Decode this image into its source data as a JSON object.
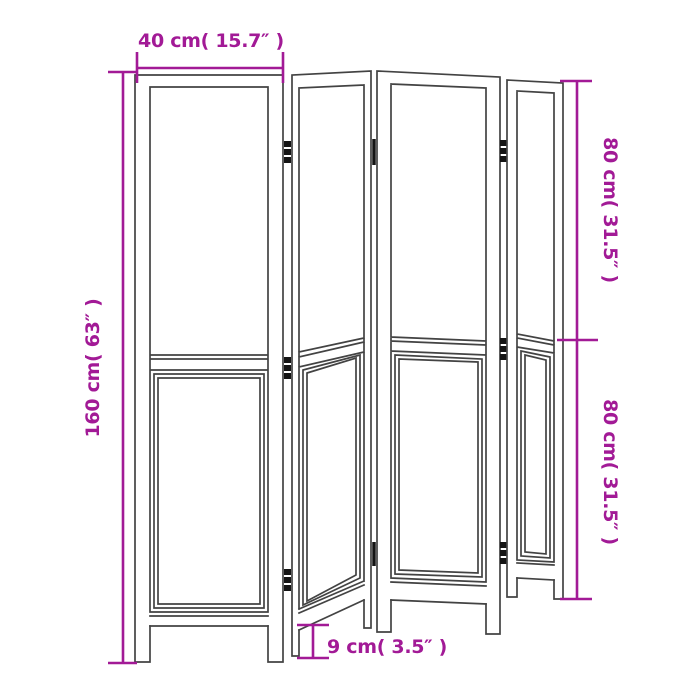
{
  "diagram": {
    "panel_count": 4,
    "hinge_count": 8,
    "colors": {
      "dimension": "#a21a96",
      "outline": "#434343",
      "hinge": "#141414",
      "background": "#ffffff"
    },
    "dimensions": {
      "width_top": "40 cm( 15.7″ )",
      "height_left": "160 cm( 63″ )",
      "height_upper_right": "80 cm( 31.5″ )",
      "height_lower_right": "80 cm( 31.5″ )",
      "ground_clearance": "9 cm( 3.5″ )"
    }
  }
}
